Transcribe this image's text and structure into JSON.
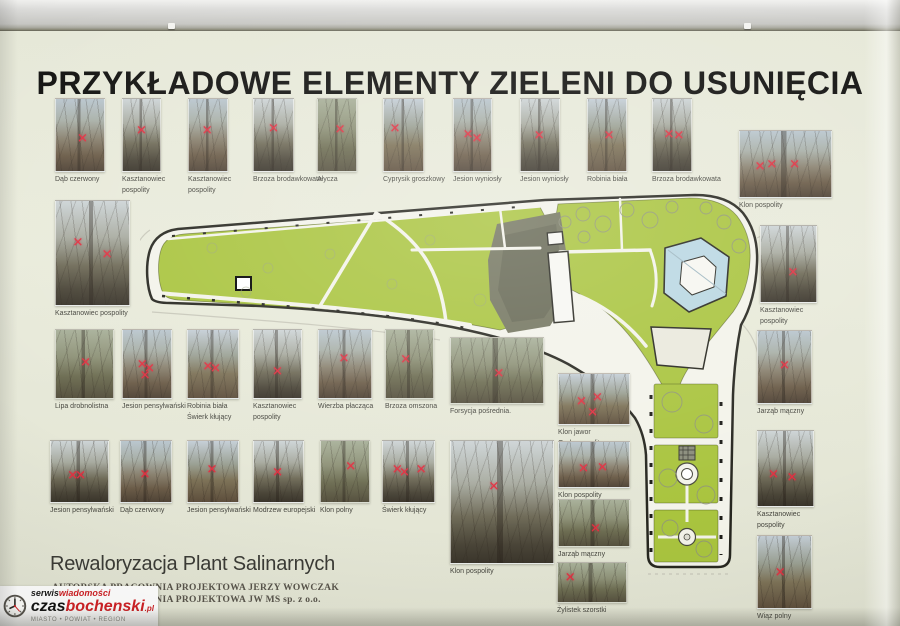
{
  "board": {
    "title": "PRZYKŁADOWE ELEMENTY ZIELENI DO USUNIĘCIA",
    "project": {
      "heading": "Rewaloryzacja Plant Salinarnych",
      "studio_line1": "AUTORSKA PRACOWNIA PROJEKTOWA JERZY WOWCZAK",
      "studio_line2": "AUTORSKA PRACOWNIA PROJEKTOWA JW MS sp. z o.o."
    }
  },
  "map": {
    "lawn_green": "#a9c43e",
    "water_blue": "#b9d7e2",
    "paper": "#f3f3ea",
    "outline": "#26261f"
  },
  "mark_color": "#e23040",
  "tree_photos": [
    {
      "label": "Dąb czerwony",
      "rect": [
        55,
        98,
        48,
        72
      ],
      "tone": "a",
      "marks": [
        [
          55,
          55
        ]
      ]
    },
    {
      "label": "Kasztanowiec\npospolity",
      "rect": [
        122,
        98,
        37,
        72
      ],
      "tone": "b",
      "marks": [
        [
          50,
          45
        ]
      ]
    },
    {
      "label": "Kasztanowiec\npospolity",
      "rect": [
        188,
        98,
        38,
        72
      ],
      "tone": "a",
      "marks": [
        [
          48,
          45
        ]
      ]
    },
    {
      "label": "Brzoza brodawkowata",
      "rect": [
        253,
        98,
        39,
        72
      ],
      "tone": "b",
      "marks": [
        [
          50,
          42
        ]
      ]
    },
    {
      "label": "Ałycza",
      "rect": [
        317,
        98,
        38,
        72
      ],
      "tone": "c",
      "marks": [
        [
          58,
          43
        ]
      ]
    },
    {
      "label": "Cyprysik groszkowy",
      "rect": [
        383,
        98,
        39,
        72
      ],
      "tone": "d",
      "marks": [
        [
          28,
          42
        ]
      ]
    },
    {
      "label": "Jesion wyniosły",
      "rect": [
        453,
        98,
        37,
        72
      ],
      "tone": "a",
      "marks": [
        [
          38,
          50
        ],
        [
          62,
          55
        ]
      ]
    },
    {
      "label": "Jesion wyniosły",
      "rect": [
        520,
        98,
        38,
        72
      ],
      "tone": "b",
      "marks": [
        [
          48,
          52
        ]
      ]
    },
    {
      "label": "Robinia biała",
      "rect": [
        587,
        98,
        38,
        72
      ],
      "tone": "d",
      "marks": [
        [
          55,
          52
        ]
      ]
    },
    {
      "label": "Brzoza brodawkowata",
      "rect": [
        652,
        98,
        38,
        72
      ],
      "tone": "b",
      "marks": [
        [
          42,
          50
        ],
        [
          68,
          52
        ]
      ]
    },
    {
      "label": "Klon pospolity",
      "rect": [
        739,
        130,
        91,
        66
      ],
      "tone": "a",
      "marks": [
        [
          22,
          55
        ],
        [
          35,
          52
        ],
        [
          60,
          52
        ]
      ]
    },
    {
      "label": "Kasztanowiec pospolity",
      "rect": [
        55,
        200,
        73,
        104
      ],
      "tone": "b",
      "marks": [
        [
          30,
          40
        ],
        [
          70,
          52
        ]
      ]
    },
    {
      "label": "Kasztanowiec\npospolity",
      "rect": [
        760,
        225,
        55,
        76
      ],
      "tone": "b",
      "marks": [
        [
          58,
          62
        ]
      ]
    },
    {
      "label": "Lipa drobnolistna",
      "rect": [
        55,
        329,
        57,
        68
      ],
      "tone": "c",
      "marks": [
        [
          52,
          48
        ]
      ]
    },
    {
      "label": "Jesion pensylwański",
      "rect": [
        122,
        329,
        48,
        68
      ],
      "tone": "a",
      "marks": [
        [
          40,
          52
        ],
        [
          55,
          58
        ],
        [
          46,
          68
        ]
      ]
    },
    {
      "label": "Robinia biała\nŚwierk kłujący",
      "rect": [
        187,
        329,
        50,
        68
      ],
      "tone": "d",
      "marks": [
        [
          40,
          55
        ],
        [
          55,
          57
        ]
      ]
    },
    {
      "label": "Kasztanowiec\npospolity",
      "rect": [
        253,
        329,
        47,
        68
      ],
      "tone": "b",
      "marks": [
        [
          50,
          62
        ]
      ]
    },
    {
      "label": "Wierzba płacząca",
      "rect": [
        318,
        329,
        52,
        68
      ],
      "tone": "a",
      "marks": [
        [
          48,
          42
        ]
      ]
    },
    {
      "label": "Brzoza omszona",
      "rect": [
        385,
        329,
        47,
        68
      ],
      "tone": "c",
      "marks": [
        [
          42,
          44
        ]
      ]
    },
    {
      "label": "Forsycja pośrednia.",
      "rect": [
        450,
        337,
        92,
        65
      ],
      "tone": "c",
      "marks": [
        [
          52,
          55
        ]
      ]
    },
    {
      "label": "Klon jawor\nGrab pospolity",
      "rect": [
        558,
        373,
        70,
        50
      ],
      "tone": "d",
      "marks": [
        [
          32,
          55
        ],
        [
          55,
          48
        ],
        [
          48,
          78
        ]
      ]
    },
    {
      "label": "Jarząb mączny",
      "rect": [
        757,
        330,
        53,
        72
      ],
      "tone": "a",
      "marks": [
        [
          50,
          48
        ]
      ]
    },
    {
      "label": "Jesion pensylwański",
      "rect": [
        50,
        440,
        57,
        61
      ],
      "tone": "b",
      "marks": [
        [
          38,
          58
        ],
        [
          52,
          58
        ]
      ]
    },
    {
      "label": "Dąb czerwony",
      "rect": [
        120,
        440,
        50,
        61
      ],
      "tone": "a",
      "marks": [
        [
          48,
          55
        ]
      ]
    },
    {
      "label": "Jesion pensylwański",
      "rect": [
        187,
        440,
        50,
        61
      ],
      "tone": "d",
      "marks": [
        [
          48,
          48
        ]
      ]
    },
    {
      "label": "Modrzew europejski",
      "rect": [
        253,
        440,
        49,
        61
      ],
      "tone": "b",
      "marks": [
        [
          48,
          52
        ]
      ]
    },
    {
      "label": "Klon polny",
      "rect": [
        320,
        440,
        48,
        61
      ],
      "tone": "c",
      "marks": [
        [
          62,
          42
        ]
      ]
    },
    {
      "label": "Świerk kłujący",
      "rect": [
        382,
        440,
        51,
        61
      ],
      "tone": "b",
      "marks": [
        [
          28,
          48
        ],
        [
          42,
          52
        ],
        [
          75,
          48
        ]
      ]
    },
    {
      "label": "Klon pospolity",
      "rect": [
        450,
        440,
        102,
        122
      ],
      "tone": "b",
      "marks": [
        [
          42,
          38
        ]
      ]
    },
    {
      "label": "Klon pospolity",
      "rect": [
        558,
        441,
        70,
        45
      ],
      "tone": "a",
      "marks": [
        [
          35,
          60
        ],
        [
          62,
          58
        ]
      ]
    },
    {
      "label": "Jarząb mączny",
      "rect": [
        558,
        499,
        70,
        46
      ],
      "tone": "c",
      "marks": [
        [
          52,
          62
        ]
      ]
    },
    {
      "label": "Kasztanowiec\npospolity",
      "rect": [
        757,
        430,
        55,
        75
      ],
      "tone": "b",
      "marks": [
        [
          28,
          58
        ],
        [
          62,
          62
        ]
      ]
    },
    {
      "label": "Żylistek szorstki",
      "rect": [
        557,
        562,
        68,
        39
      ],
      "tone": "c",
      "marks": [
        [
          18,
          38
        ]
      ]
    },
    {
      "label": "Wiąz polny",
      "rect": [
        757,
        535,
        53,
        72
      ],
      "tone": "d",
      "marks": [
        [
          42,
          52
        ]
      ]
    }
  ],
  "logo": {
    "serwis": "serwis",
    "wiadomosci": "wiadomości",
    "czas": "czas",
    "bochenski": "bochenski",
    "pl": ".pl",
    "tagline": "MIASTO • POWIAT • REGION",
    "red": "#cf1f24"
  }
}
